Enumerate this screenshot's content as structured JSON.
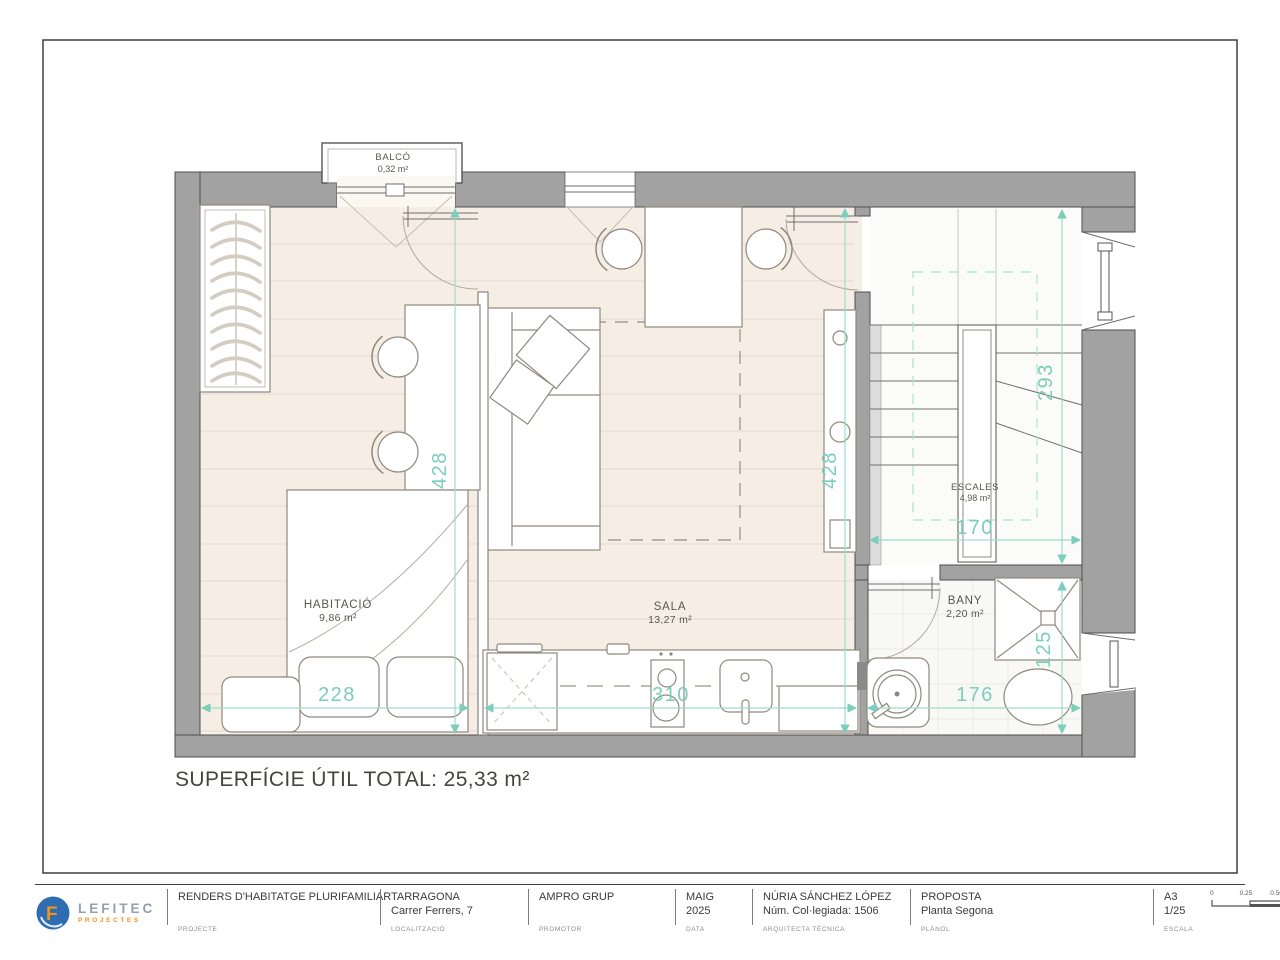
{
  "plan": {
    "rooms": [
      {
        "id": "balco",
        "name": "BALCÓ",
        "area": "0,32 m²"
      },
      {
        "id": "habitacio",
        "name": "HABITACIÓ",
        "area": "9,86 m²"
      },
      {
        "id": "sala",
        "name": "SALA",
        "area": "13,27 m²"
      },
      {
        "id": "escales",
        "name": "ESCALES",
        "area": "4,98 m²"
      },
      {
        "id": "bany",
        "name": "BANY",
        "area": "2,20 m²"
      }
    ],
    "dimensions": [
      {
        "id": "habitacio-height",
        "value": "428"
      },
      {
        "id": "sala-height",
        "value": "428"
      },
      {
        "id": "escales-height",
        "value": "293"
      },
      {
        "id": "escales-width",
        "value": "170"
      },
      {
        "id": "shower-height",
        "value": "125"
      },
      {
        "id": "bed-width",
        "value": "228"
      },
      {
        "id": "kitchen-width",
        "value": "310"
      },
      {
        "id": "bany-width",
        "value": "176"
      }
    ],
    "total_label": "SUPERFÍCIE ÚTIL TOTAL: 25,33 m²",
    "colors": {
      "dimension_text": "#7ccdbb",
      "dimension_line": "#9fdccd",
      "wall": "#a2a2a2",
      "wood_floor": "#f6eee5"
    }
  },
  "titleblock": {
    "logo": {
      "icon": "lefitec-logo-icon",
      "text": "LEFITEC",
      "sub": "PROJECTES",
      "circle_color": "#2f6db3",
      "accent_color": "#ef941e"
    },
    "cells": [
      {
        "line1": "RENDERS D'HABITATGE PLURIFAMILIAR",
        "line2": "",
        "label": "PROJECTE"
      },
      {
        "line1": "TARRAGONA",
        "line2": "Carrer Ferrers, 7",
        "label": "LOCALITZACIÓ"
      },
      {
        "line1": "AMPRO GRUP",
        "line2": "",
        "label": "PROMOTOR"
      },
      {
        "line1": "MAIG",
        "line2": "2025",
        "label": "DATA"
      },
      {
        "line1": "NÚRIA SÁNCHEZ LÓPEZ",
        "line2": "Núm. Col·legiada: 1506",
        "label": "ARQUITECTA TÈCNICA"
      },
      {
        "line1": "PROPOSTA",
        "line2": "Planta Segona",
        "label": "PLÀNOL"
      },
      {
        "line1": "A3",
        "line2": "1/25",
        "label": "ESCALA"
      }
    ],
    "scalebar": {
      "ticks": [
        "0",
        "0.25",
        "0.50"
      ]
    },
    "sheet": {
      "code": "P.02",
      "label": "RF. PLÀNOL"
    }
  }
}
